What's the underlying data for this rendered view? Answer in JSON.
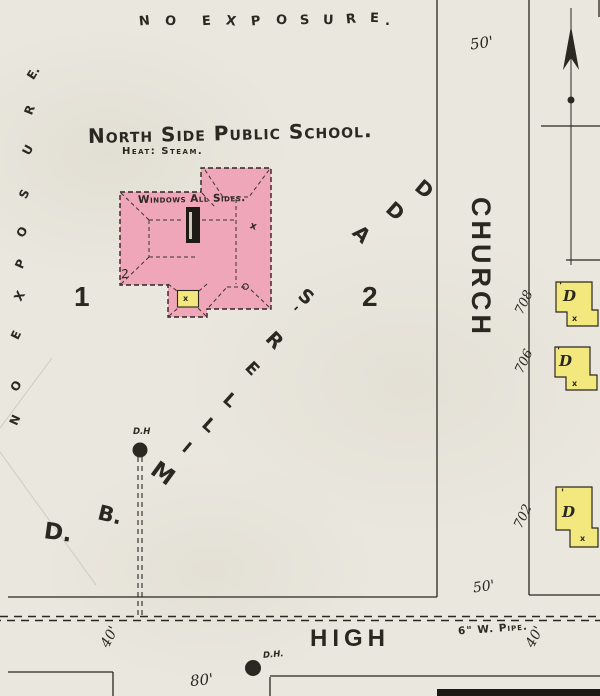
{
  "colors": {
    "paper": "#eae7de",
    "ink": "#2b2721",
    "building_pink": "#efa6b9",
    "dwelling_yellow": "#f2e87d",
    "chimney_black": "#1d1a16"
  },
  "header": {
    "school_name": "North Side Public School.",
    "heat_note": "Heat: Steam."
  },
  "building": {
    "note": "Windows All Sides.",
    "stories": "2",
    "roof_mark": "x",
    "porch_mark": "x"
  },
  "lots": {
    "lot1": "1",
    "lot2": "2"
  },
  "addition": {
    "text": "D. B. MILLER'S ADD",
    "letters": [
      {
        "ch": "D.",
        "x": 44,
        "y": 520,
        "r": 8,
        "s": 23
      },
      {
        "ch": "B.",
        "x": 98,
        "y": 503,
        "r": 14,
        "s": 21
      },
      {
        "ch": "M",
        "x": 151,
        "y": 461,
        "r": 36,
        "s": 23
      },
      {
        "ch": "I",
        "x": 184,
        "y": 438,
        "r": 40,
        "s": 16
      },
      {
        "ch": "L",
        "x": 203,
        "y": 415,
        "r": 42,
        "s": 18
      },
      {
        "ch": "L",
        "x": 224,
        "y": 390,
        "r": 42,
        "s": 18
      },
      {
        "ch": "E",
        "x": 246,
        "y": 359,
        "r": 46,
        "s": 17
      },
      {
        "ch": "R",
        "x": 267,
        "y": 328,
        "r": 46,
        "s": 20
      },
      {
        "ch": "'",
        "x": 291,
        "y": 302,
        "r": 46,
        "s": 15
      },
      {
        "ch": "S",
        "x": 299,
        "y": 286,
        "r": 40,
        "s": 19
      },
      {
        "ch": "A",
        "x": 354,
        "y": 222,
        "r": 44,
        "s": 20
      },
      {
        "ch": "D",
        "x": 387,
        "y": 199,
        "r": 42,
        "s": 20
      },
      {
        "ch": "D",
        "x": 416,
        "y": 177,
        "r": 40,
        "s": 20
      }
    ]
  },
  "no_exposure": {
    "top": {
      "text": "NO EXPOSURE.",
      "letters": [
        {
          "ch": "N",
          "x": 139,
          "y": 14,
          "r": -6
        },
        {
          "ch": "O",
          "x": 165,
          "y": 14,
          "r": 6
        },
        {
          "ch": "E",
          "x": 202,
          "y": 14,
          "r": -4
        },
        {
          "ch": "X",
          "x": 226,
          "y": 14,
          "r": 8
        },
        {
          "ch": "P",
          "x": 251,
          "y": 14,
          "r": -6
        },
        {
          "ch": "O",
          "x": 276,
          "y": 13,
          "r": 4
        },
        {
          "ch": "S",
          "x": 300,
          "y": 13,
          "r": -4
        },
        {
          "ch": "U",
          "x": 323,
          "y": 13,
          "r": 2
        },
        {
          "ch": "R",
          "x": 346,
          "y": 12,
          "r": -6
        },
        {
          "ch": "E",
          "x": 370,
          "y": 11,
          "r": 2
        },
        {
          "ch": ".",
          "x": 385,
          "y": 14,
          "r": 0
        }
      ]
    },
    "left": {
      "text": "NO EXPOSURE.",
      "letters": [
        {
          "ch": "E.",
          "x": 27,
          "y": 66,
          "r": -58
        },
        {
          "ch": "R",
          "x": 25,
          "y": 103,
          "r": -68
        },
        {
          "ch": "U",
          "x": 23,
          "y": 143,
          "r": -62
        },
        {
          "ch": "S",
          "x": 20,
          "y": 187,
          "r": -64
        },
        {
          "ch": "O",
          "x": 17,
          "y": 225,
          "r": -58
        },
        {
          "ch": "P",
          "x": 16,
          "y": 257,
          "r": -66
        },
        {
          "ch": "X",
          "x": 15,
          "y": 289,
          "r": -60
        },
        {
          "ch": "E",
          "x": 12,
          "y": 328,
          "r": -64
        },
        {
          "ch": "O",
          "x": 11,
          "y": 379,
          "r": -58
        },
        {
          "ch": "N",
          "x": 10,
          "y": 413,
          "r": -66
        }
      ]
    }
  },
  "streets": {
    "church": "CHURCH",
    "high": "HIGH",
    "pipe_label": "6\" W. Pipe.",
    "church_width_north": "50'",
    "church_width_south": "50'",
    "high_width_west": "40'",
    "high_width_east": "40'",
    "lot_frontage": "80'"
  },
  "house_numbers": [
    {
      "t": "708"
    },
    {
      "t": "706"
    },
    {
      "t": "702"
    }
  ],
  "hydrants": {
    "north": "D.H",
    "south": "D.H."
  },
  "dwellings": [
    {
      "label": "D",
      "attic": "'",
      "mark": "x"
    },
    {
      "label": "D",
      "attic": "'",
      "mark": "x"
    },
    {
      "label": "D",
      "attic": "'",
      "mark": "x"
    }
  ]
}
